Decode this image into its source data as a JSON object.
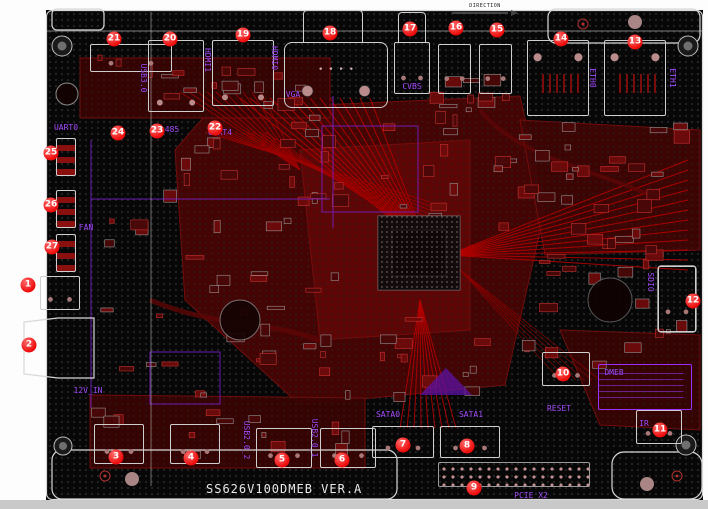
{
  "board": {
    "title": "SS626V100DMEB VER.A",
    "direction_label": "DIRECTION",
    "colors": {
      "board": "#070707",
      "copper_pour": "#4d0505",
      "trace": "#c40000",
      "silkscreen": "#a64dff",
      "outline": "#d8d8d8",
      "callout": "#ee0a0a"
    }
  },
  "callouts": [
    {
      "n": 1,
      "x": 28,
      "y": 285
    },
    {
      "n": 2,
      "x": 29,
      "y": 345
    },
    {
      "n": 3,
      "x": 116,
      "y": 457
    },
    {
      "n": 4,
      "x": 191,
      "y": 458
    },
    {
      "n": 5,
      "x": 282,
      "y": 460
    },
    {
      "n": 6,
      "x": 342,
      "y": 460
    },
    {
      "n": 7,
      "x": 403,
      "y": 445
    },
    {
      "n": 8,
      "x": 467,
      "y": 446
    },
    {
      "n": 9,
      "x": 474,
      "y": 488
    },
    {
      "n": 10,
      "x": 563,
      "y": 374
    },
    {
      "n": 11,
      "x": 660,
      "y": 430
    },
    {
      "n": 12,
      "x": 693,
      "y": 301
    },
    {
      "n": 13,
      "x": 635,
      "y": 42
    },
    {
      "n": 14,
      "x": 561,
      "y": 39
    },
    {
      "n": 15,
      "x": 497,
      "y": 30
    },
    {
      "n": 16,
      "x": 456,
      "y": 28
    },
    {
      "n": 17,
      "x": 410,
      "y": 29
    },
    {
      "n": 18,
      "x": 330,
      "y": 33
    },
    {
      "n": 19,
      "x": 243,
      "y": 35
    },
    {
      "n": 20,
      "x": 170,
      "y": 39
    },
    {
      "n": 21,
      "x": 114,
      "y": 39
    },
    {
      "n": 22,
      "x": 215,
      "y": 128
    },
    {
      "n": 23,
      "x": 157,
      "y": 131
    },
    {
      "n": 24,
      "x": 118,
      "y": 133
    },
    {
      "n": 25,
      "x": 51,
      "y": 153
    },
    {
      "n": 26,
      "x": 51,
      "y": 205
    },
    {
      "n": 27,
      "x": 52,
      "y": 247
    }
  ],
  "silkscreen_labels": [
    {
      "text": "USB3.0",
      "x": 143,
      "y": 78,
      "vertical": true
    },
    {
      "text": "HDMI1",
      "x": 207,
      "y": 60,
      "vertical": true
    },
    {
      "text": "HDMI0",
      "x": 274,
      "y": 58,
      "vertical": true
    },
    {
      "text": "VGA",
      "x": 293,
      "y": 95,
      "vertical": false
    },
    {
      "text": "CVBS",
      "x": 412,
      "y": 87,
      "vertical": false
    },
    {
      "text": "ETH0",
      "x": 592,
      "y": 78,
      "vertical": true
    },
    {
      "text": "ETH1",
      "x": 672,
      "y": 78,
      "vertical": true
    },
    {
      "text": "UART0",
      "x": 66,
      "y": 128,
      "vertical": false
    },
    {
      "text": "485",
      "x": 172,
      "y": 130,
      "vertical": false
    },
    {
      "text": "UART4",
      "x": 220,
      "y": 133,
      "vertical": false
    },
    {
      "text": "FAN",
      "x": 86,
      "y": 228,
      "vertical": false
    },
    {
      "text": "12V_IN",
      "x": 88,
      "y": 391,
      "vertical": false
    },
    {
      "text": "USB2.0_2",
      "x": 246,
      "y": 440,
      "vertical": true
    },
    {
      "text": "USB2.0_1",
      "x": 314,
      "y": 438,
      "vertical": true
    },
    {
      "text": "SATA0",
      "x": 388,
      "y": 415,
      "vertical": false
    },
    {
      "text": "SATA1",
      "x": 471,
      "y": 415,
      "vertical": false
    },
    {
      "text": "PCIE X2",
      "x": 531,
      "y": 496,
      "vertical": false
    },
    {
      "text": "RESET",
      "x": 559,
      "y": 409,
      "vertical": false
    },
    {
      "text": "DMEB",
      "x": 614,
      "y": 373,
      "vertical": false
    },
    {
      "text": "IR",
      "x": 644,
      "y": 424,
      "vertical": false
    },
    {
      "text": "SDIO",
      "x": 650,
      "y": 282,
      "vertical": true
    }
  ],
  "connectors": [
    {
      "name": "audio-header",
      "kind": "box",
      "x": 90,
      "y": 44,
      "w": 82,
      "h": 28
    },
    {
      "name": "usb3-port",
      "kind": "tall",
      "x": 148,
      "y": 40,
      "w": 56,
      "h": 72
    },
    {
      "name": "hdmi1-port",
      "kind": "tall",
      "x": 212,
      "y": 40,
      "w": 62,
      "h": 66
    },
    {
      "name": "vga-port",
      "kind": "dsub",
      "x": 284,
      "y": 42,
      "w": 104,
      "h": 66
    },
    {
      "name": "vga-tab",
      "kind": "tab",
      "x": 303,
      "y": 10,
      "w": 60,
      "h": 33
    },
    {
      "name": "cvbs-jack",
      "kind": "box",
      "x": 394,
      "y": 42,
      "w": 36,
      "h": 52
    },
    {
      "name": "cvbs-tab",
      "kind": "tab",
      "x": 398,
      "y": 12,
      "w": 28,
      "h": 31
    },
    {
      "name": "jack-16",
      "kind": "box",
      "x": 438,
      "y": 44,
      "w": 33,
      "h": 50
    },
    {
      "name": "jack-15",
      "kind": "box",
      "x": 479,
      "y": 44,
      "w": 33,
      "h": 50
    },
    {
      "name": "eth0-port",
      "kind": "rj45",
      "x": 527,
      "y": 40,
      "w": 62,
      "h": 76
    },
    {
      "name": "eth1-port",
      "kind": "rj45",
      "x": 604,
      "y": 40,
      "w": 62,
      "h": 76
    },
    {
      "name": "uart0-header",
      "kind": "sideheader",
      "x": 56,
      "y": 138,
      "w": 20,
      "h": 38
    },
    {
      "name": "header-26",
      "kind": "sideheader",
      "x": 56,
      "y": 190,
      "w": 20,
      "h": 38
    },
    {
      "name": "fan-header",
      "kind": "sideheader",
      "x": 56,
      "y": 234,
      "w": 20,
      "h": 38
    },
    {
      "name": "connector-1",
      "kind": "box",
      "x": 40,
      "y": 276,
      "w": 40,
      "h": 34
    },
    {
      "name": "dc-jack",
      "kind": "none",
      "x": 24,
      "y": 318,
      "w": 70,
      "h": 60
    },
    {
      "name": "connector-3",
      "kind": "box",
      "x": 94,
      "y": 424,
      "w": 50,
      "h": 40
    },
    {
      "name": "connector-4",
      "kind": "box",
      "x": 170,
      "y": 424,
      "w": 50,
      "h": 40
    },
    {
      "name": "connector-5",
      "kind": "box",
      "x": 256,
      "y": 428,
      "w": 56,
      "h": 40
    },
    {
      "name": "connector-6",
      "kind": "box",
      "x": 320,
      "y": 428,
      "w": 56,
      "h": 40
    },
    {
      "name": "sata0-conn",
      "kind": "box",
      "x": 372,
      "y": 426,
      "w": 62,
      "h": 32
    },
    {
      "name": "sata1-conn",
      "kind": "box",
      "x": 440,
      "y": 426,
      "w": 60,
      "h": 32
    },
    {
      "name": "pcie-header",
      "kind": "pinheader",
      "x": 438,
      "y": 462,
      "w": 152,
      "h": 25
    },
    {
      "name": "reset-conn",
      "kind": "box",
      "x": 542,
      "y": 352,
      "w": 48,
      "h": 34
    },
    {
      "name": "ir-conn",
      "kind": "box",
      "x": 636,
      "y": 410,
      "w": 46,
      "h": 34
    },
    {
      "name": "sdio-conn",
      "kind": "box",
      "x": 658,
      "y": 266,
      "w": 38,
      "h": 66
    },
    {
      "name": "dmeb-table",
      "kind": "dmeb",
      "x": 598,
      "y": 364,
      "w": 94,
      "h": 46
    }
  ]
}
